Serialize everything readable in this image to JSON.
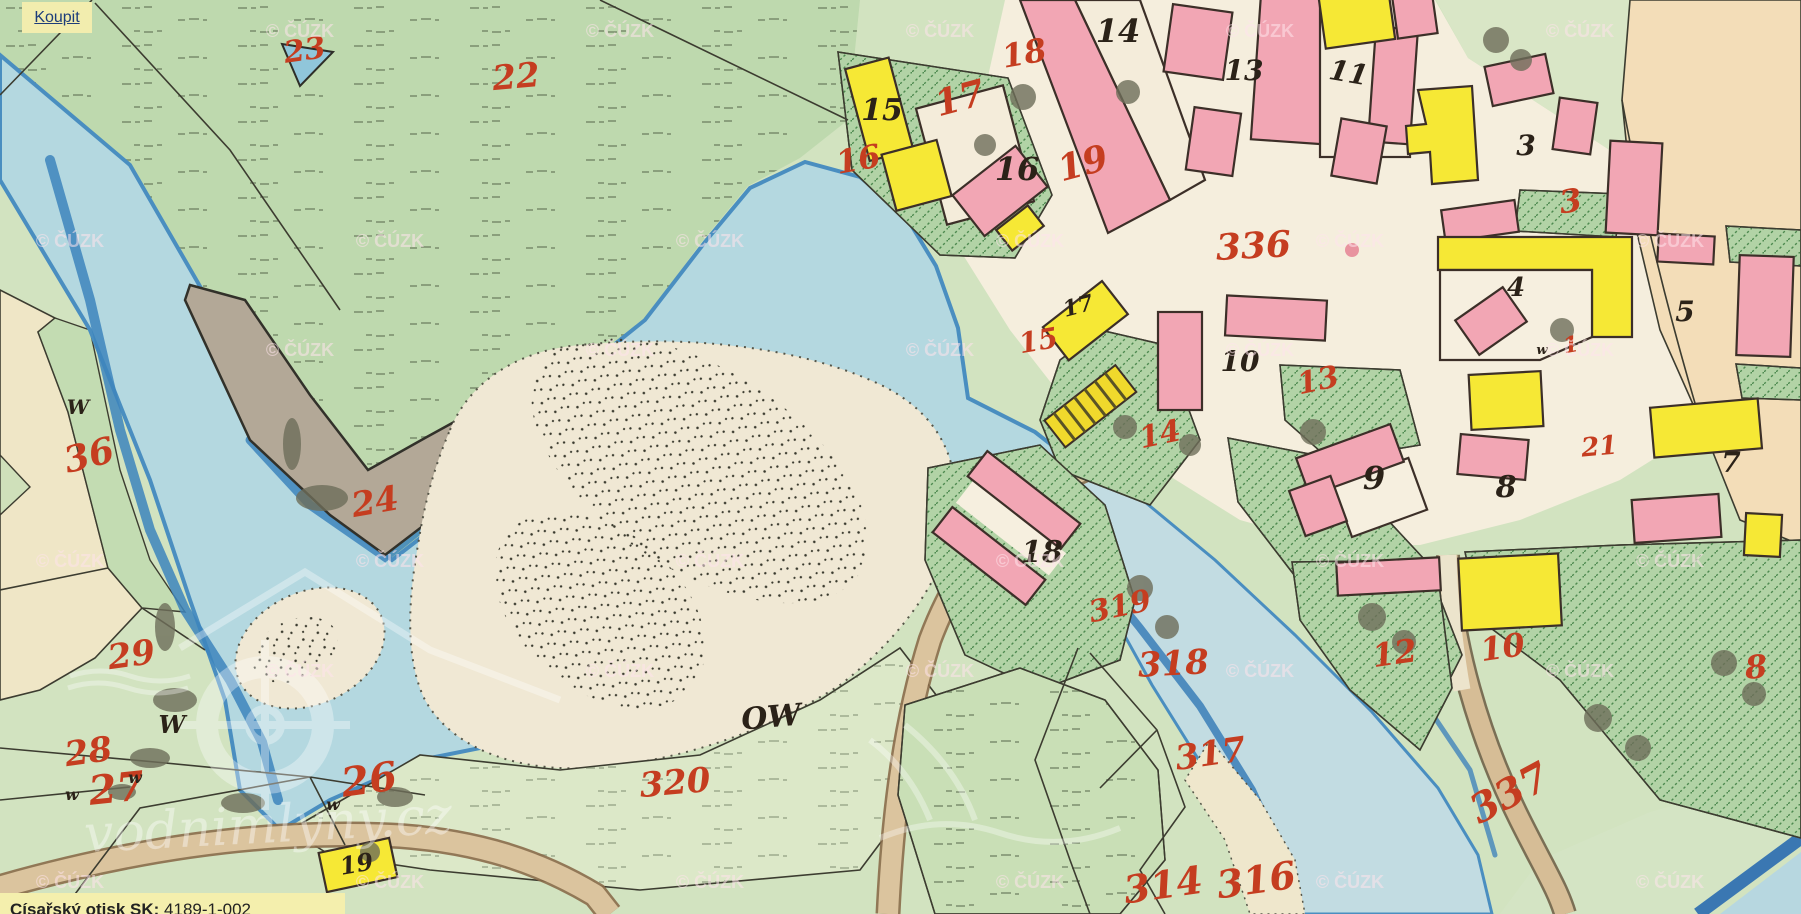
{
  "viewer": {
    "buy_button": {
      "label": "Koupit"
    },
    "info_bar": {
      "label": "Císařský otisk SK:",
      "value": "4189-1-002"
    },
    "copyright_watermark": "© ČÚZK",
    "brand_watermark": "vodnimlyny.cz"
  },
  "map": {
    "description": "Historical imperial cadastral map sheet (císařský otisk) of a village on a river",
    "colors": {
      "meadow_green": "#bed9ae",
      "pale_field_green": "#d2e3c0",
      "garden_hatch_green": "#b2d3a6",
      "water_light": "#b4d8e0",
      "water_bank_blue": "#4a8ec0",
      "sandbar_cream": "#f0e8d4",
      "mud_gray": "#b3a897",
      "plaza_cream": "#f5eedd",
      "peach_field": "#f3ddb8",
      "building_pink": "#f2a6b4",
      "building_yellow": "#f6e835",
      "road_tan": "#dbc49e",
      "red_number": "#c53d20",
      "black_number": "#2b2218",
      "watermark_pink": "#ffe4ec",
      "ui_yellow": "#f2edae",
      "link_blue": "#1d3d7a"
    },
    "red_parcel_numbers": [
      {
        "n": "23",
        "x": 306,
        "y": 60,
        "s": 30,
        "r": -8
      },
      {
        "n": "22",
        "x": 517,
        "y": 88,
        "s": 34,
        "r": -5
      },
      {
        "n": "36",
        "x": 92,
        "y": 467,
        "s": 36,
        "r": -14
      },
      {
        "n": "24",
        "x": 377,
        "y": 513,
        "s": 34,
        "r": -10
      },
      {
        "n": "29",
        "x": 133,
        "y": 666,
        "s": 34,
        "r": -8
      },
      {
        "n": "28",
        "x": 90,
        "y": 763,
        "s": 34,
        "r": -8
      },
      {
        "n": "27",
        "x": 118,
        "y": 802,
        "s": 40,
        "r": -6
      },
      {
        "n": "26",
        "x": 371,
        "y": 793,
        "s": 40,
        "r": -8
      },
      {
        "n": "16",
        "x": 860,
        "y": 170,
        "s": 32,
        "r": -10
      },
      {
        "n": "17",
        "x": 963,
        "y": 110,
        "s": 36,
        "r": -15
      },
      {
        "n": "18",
        "x": 1026,
        "y": 64,
        "s": 32,
        "r": -10
      },
      {
        "n": "19",
        "x": 1086,
        "y": 175,
        "s": 36,
        "r": -15
      },
      {
        "n": "15",
        "x": 1040,
        "y": 350,
        "s": 28,
        "r": -10
      },
      {
        "n": "14",
        "x": 1162,
        "y": 444,
        "s": 30,
        "r": -12
      },
      {
        "n": "13",
        "x": 1320,
        "y": 390,
        "s": 30,
        "r": -12
      },
      {
        "n": "336",
        "x": 1254,
        "y": 258,
        "s": 36,
        "r": -3
      },
      {
        "n": "3",
        "x": 1572,
        "y": 212,
        "s": 32,
        "r": -8
      },
      {
        "n": "319",
        "x": 1122,
        "y": 616,
        "s": 30,
        "r": -12
      },
      {
        "n": "318",
        "x": 1174,
        "y": 675,
        "s": 34,
        "r": -3
      },
      {
        "n": "317",
        "x": 1212,
        "y": 765,
        "s": 34,
        "r": -8
      },
      {
        "n": "320",
        "x": 676,
        "y": 794,
        "s": 34,
        "r": -5
      },
      {
        "n": "314",
        "x": 1165,
        "y": 898,
        "s": 38,
        "r": -8
      },
      {
        "n": "316",
        "x": 1258,
        "y": 893,
        "s": 38,
        "r": -8
      },
      {
        "n": "337",
        "x": 1516,
        "y": 805,
        "s": 40,
        "r": -28
      },
      {
        "n": "12",
        "x": 1396,
        "y": 664,
        "s": 32,
        "r": -8
      },
      {
        "n": "10",
        "x": 1504,
        "y": 658,
        "s": 32,
        "r": -8
      },
      {
        "n": "8",
        "x": 1757,
        "y": 678,
        "s": 32,
        "r": -5
      },
      {
        "n": "21",
        "x": 1600,
        "y": 455,
        "s": 26,
        "r": -5
      },
      {
        "n": "1",
        "x": 1572,
        "y": 352,
        "s": 22,
        "r": -10
      }
    ],
    "black_house_numbers": [
      {
        "n": "14",
        "x": 1118,
        "y": 42,
        "s": 32,
        "r": 0
      },
      {
        "n": "13",
        "x": 1244,
        "y": 80,
        "s": 28,
        "r": 0
      },
      {
        "n": "11",
        "x": 1347,
        "y": 82,
        "s": 28,
        "r": 10
      },
      {
        "n": "15",
        "x": 882,
        "y": 120,
        "s": 30,
        "r": 0
      },
      {
        "n": "16",
        "x": 1017,
        "y": 180,
        "s": 32,
        "r": 0
      },
      {
        "n": "17",
        "x": 1080,
        "y": 313,
        "s": 22,
        "r": -15
      },
      {
        "n": "3",
        "x": 1526,
        "y": 155,
        "s": 28,
        "r": 0
      },
      {
        "n": "4",
        "x": 1516,
        "y": 296,
        "s": 26,
        "r": 0
      },
      {
        "n": "5",
        "x": 1685,
        "y": 321,
        "s": 28,
        "r": 0
      },
      {
        "n": "10",
        "x": 1240,
        "y": 371,
        "s": 28,
        "r": 0
      },
      {
        "n": "9",
        "x": 1374,
        "y": 489,
        "s": 32,
        "r": 0
      },
      {
        "n": "8",
        "x": 1506,
        "y": 497,
        "s": 30,
        "r": 0
      },
      {
        "n": "7",
        "x": 1731,
        "y": 472,
        "s": 28,
        "r": 0
      },
      {
        "n": "18",
        "x": 1042,
        "y": 562,
        "s": 30,
        "r": 0
      },
      {
        "n": "19",
        "x": 358,
        "y": 872,
        "s": 24,
        "r": -10
      }
    ],
    "letter_annotations": [
      {
        "t": "OW",
        "x": 772,
        "y": 727,
        "s": 30,
        "r": -5
      },
      {
        "t": "W",
        "x": 78,
        "y": 414,
        "s": 20,
        "r": 0
      },
      {
        "t": "W",
        "x": 172,
        "y": 733,
        "s": 24,
        "r": 0
      },
      {
        "t": "w",
        "x": 135,
        "y": 783,
        "s": 16,
        "r": 0
      },
      {
        "t": "w",
        "x": 72,
        "y": 800,
        "s": 16,
        "r": 0
      },
      {
        "t": "w",
        "x": 333,
        "y": 810,
        "s": 16,
        "r": 0
      },
      {
        "t": "w",
        "x": 1542,
        "y": 354,
        "s": 13,
        "r": 0
      }
    ],
    "watermark_rows": [
      {
        "y": 37,
        "xs": [
          260,
          580,
          900,
          1220,
          1540
        ]
      },
      {
        "y": 247,
        "xs": [
          30,
          350,
          670,
          990,
          1310,
          1630
        ]
      },
      {
        "y": 356,
        "xs": [
          260,
          580,
          900,
          1220,
          1540
        ]
      },
      {
        "y": 567,
        "xs": [
          30,
          350,
          670,
          990,
          1310,
          1630
        ]
      },
      {
        "y": 677,
        "xs": [
          260,
          580,
          900,
          1220,
          1540
        ]
      },
      {
        "y": 888,
        "xs": [
          30,
          350,
          670,
          990,
          1310,
          1630
        ]
      }
    ]
  }
}
